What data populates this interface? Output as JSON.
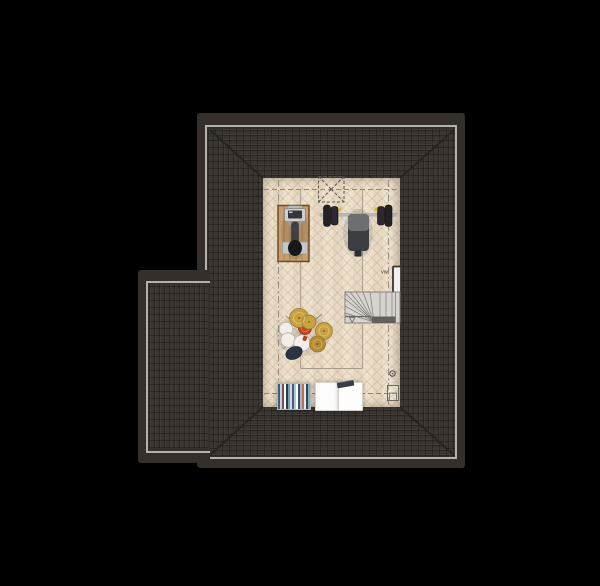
{
  "labels": {
    "radiator_valve": "vw"
  },
  "palette": {
    "bg": "#000000",
    "roof-border": "#352f2b",
    "roof-frame": "#b3b1ad",
    "roof-tile": "#3a3531",
    "roof-tile-line": "#2b2723",
    "floor": "#ecdfc9",
    "floor-line": "#a89d8c",
    "headroom-line": "#8d8577",
    "hip-line": "#26221e",
    "stair-fill": "#d7d4d0",
    "stair-line": "#7d7973",
    "stair-landing": "#63605b",
    "mat-wood": "#c79e6c",
    "mat-border": "#6e4c2a",
    "bench-dark": "#3c3e42",
    "bench-light": "#6c6e72",
    "barbell-bar": "#b6b9bd",
    "plate-black": "#222225",
    "accent-yellow": "#d9bb32",
    "drum-gold": "#c7a23f",
    "drum-bronze": "#b38c33",
    "drum-red": "#c2491c",
    "drum-white": "#f2efe9",
    "drum-navy": "#2b3442",
    "radiator-white": "#f2f1ef"
  },
  "furniture": {
    "exercise-bike": "stationary exercise bike on wooden mat (top view)",
    "weight-bench": "flat bench with barbell and plates",
    "drum-kit": "drum kit with cymbals and stool",
    "staircase": "winder staircase going down",
    "roof-window": "dashed skylight symbol",
    "radiator": "wall radiator",
    "bookshelf": "shelf with books/clothes",
    "cabinets": "two white cabinets with laptop",
    "mech-unit": "small mechanical vent unit"
  },
  "bookshelf": {
    "stripe_colors": [
      "#3d5a80",
      "#c0d4e4",
      "#8a4a3a",
      "#ffffff",
      "#2b3a55",
      "#7aa0b8",
      "#d8d8d8",
      "#44607a",
      "#b0c8d8",
      "#ffffff",
      "#35506e",
      "#9fb8cc",
      "#c46a4a",
      "#e8e8e8",
      "#2e4866",
      "#88a8c0"
    ]
  }
}
